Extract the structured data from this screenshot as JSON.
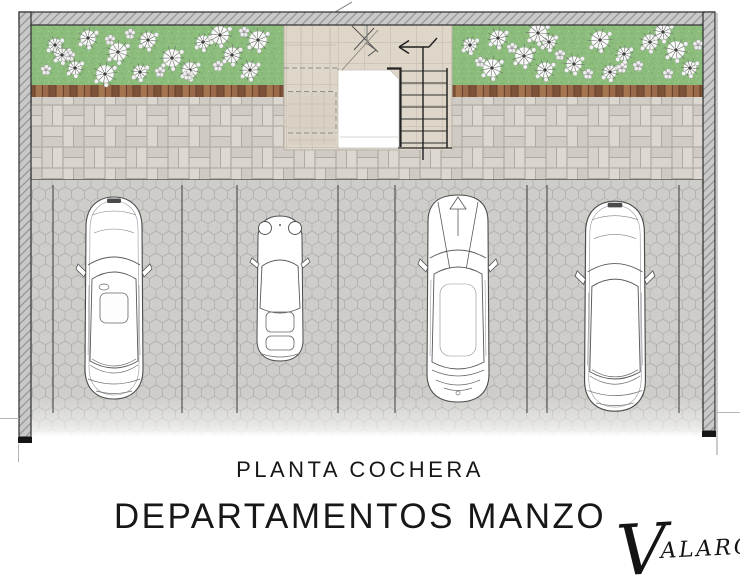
{
  "titles": {
    "subtitle": "PLANTA COCHERA",
    "title": "DEPARTAMENTOS MANZO"
  },
  "signature": {
    "initial": "V",
    "rest": "ALARQ."
  },
  "colors": {
    "title": "#171717",
    "wall_fill": "#c9c9c9",
    "wall_line": "#2e2e2e",
    "grass": "#8cbd7d",
    "grass_dark": "#78ab69",
    "wood": "#8f5f41",
    "walk_brick": "#d6d2cb",
    "walk_grout": "#b0aba2",
    "hex_fill": "#cecdc9",
    "hex_line": "#b3b1ad",
    "stair_tile": "#ddd6c9",
    "line_dark": "#3c3c3c",
    "car_line": "#4c4c4c"
  },
  "plan": {
    "areas": [
      {
        "name": "planting-bed-left",
        "type": "garden-with-flowers"
      },
      {
        "name": "planting-bed-right",
        "type": "garden-with-flowers"
      },
      {
        "name": "timber-edge-strip",
        "type": "wood-planks"
      },
      {
        "name": "paver-walkway",
        "type": "basketweave-pavers"
      },
      {
        "name": "parking-court",
        "type": "hexagonal-pavers"
      },
      {
        "name": "entry-stair",
        "type": "staircase-with-up-arrow"
      }
    ],
    "stalls": [
      {
        "number": 1,
        "vehicle": "sedan"
      },
      {
        "number": 2,
        "vehicle": "compact-coupe"
      },
      {
        "number": 3,
        "vehicle": "suv"
      },
      {
        "number": 4,
        "vehicle": "sedan"
      }
    ]
  }
}
